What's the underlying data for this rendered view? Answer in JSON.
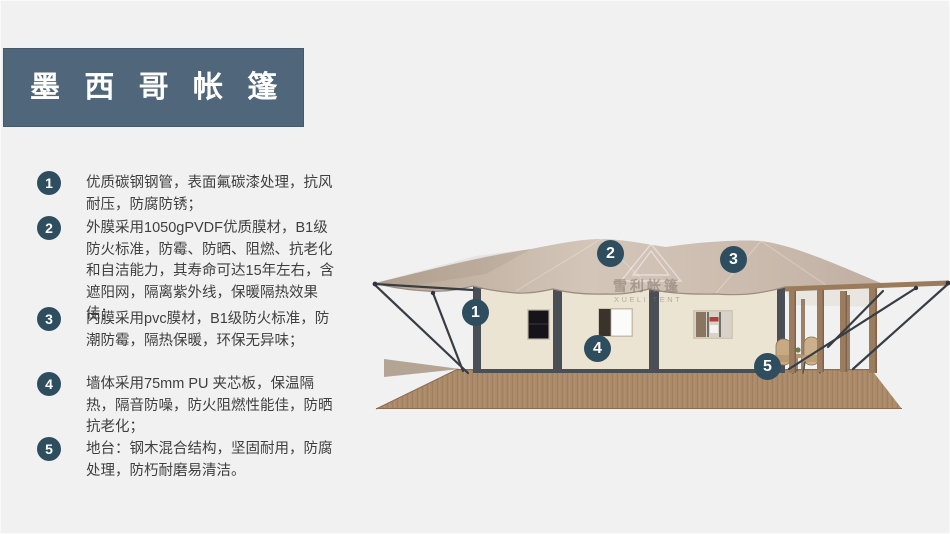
{
  "title": {
    "text": "墨 西 哥 帐 篷"
  },
  "features": {
    "items": [
      {
        "num": "1",
        "text": "优质碳钢钢管，表面氟碳漆处理，抗风耐压，防腐防锈；"
      },
      {
        "num": "2",
        "text": "外膜采用1050gPVDF优质膜材，B1级防火标准，防霉、防晒、阻燃、抗老化和自洁能力，其寿命可达15年左右，含遮阳网，隔离紫外线，保暖隔热效果佳；"
      },
      {
        "num": "3",
        "text": "内膜采用pvc膜材，B1级防火标准，防潮防霉，隔热保暖，环保无异味；"
      },
      {
        "num": "4",
        "text": "墙体采用75mm PU 夹芯板，保温隔热，隔音防噪，防火阻燃性能佳，防晒抗老化；"
      },
      {
        "num": "5",
        "text": "地台：钢木混合结构，坚固耐用，防腐处理，防朽耐磨易清洁。"
      }
    ]
  },
  "illustration": {
    "watermark": {
      "cn": "雪利帐篷",
      "en": "XUELI TENT",
      "logo_icon": "tent-logo-icon"
    },
    "callouts": [
      {
        "num": "1"
      },
      {
        "num": "2"
      },
      {
        "num": "3"
      },
      {
        "num": "4"
      },
      {
        "num": "5"
      }
    ]
  },
  "colors": {
    "page_bg": "#f1f1f2",
    "title_bg": "#50667a",
    "badge": "#2e4e5f",
    "body_text": "#3f3f3f",
    "roof": "#c8b7aa",
    "wall": "#ece4d3",
    "frame": "#4a4e55",
    "deck": "#ab8a69",
    "wood_post": "#9b7c5e",
    "cable": "#383d44"
  }
}
